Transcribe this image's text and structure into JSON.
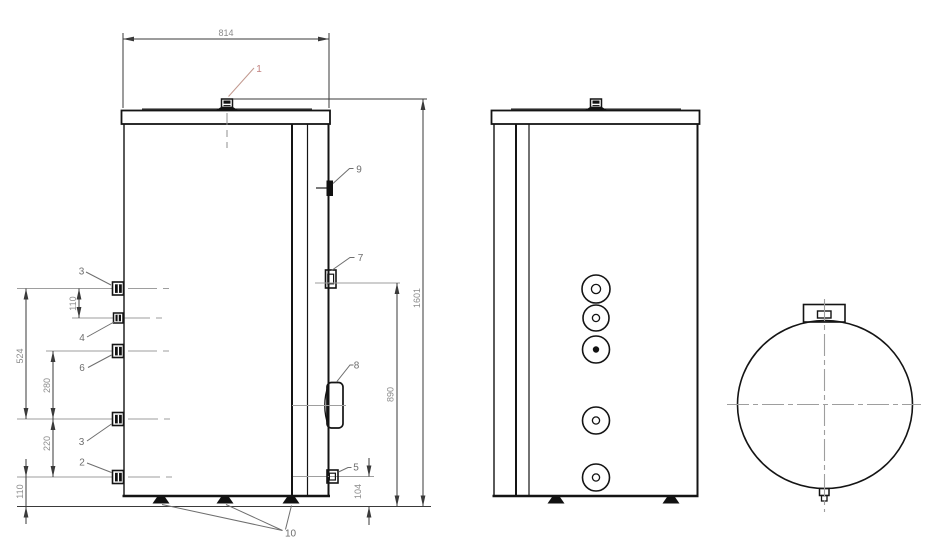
{
  "drawing": {
    "type": "tank-technical-drawing",
    "colors": {
      "line": "#141414",
      "dimension_line": "#3a3a3a",
      "dimension_text": "#8c8c8c",
      "centerline": "#9e9e9e",
      "callout_text": "#6e6e6e",
      "callout_highlight": "#c2807f"
    },
    "dimensions": {
      "top_width": "814",
      "overall_height": "1601",
      "port7_height": "890",
      "port5_height": "104",
      "port3_to_port4": "110",
      "port3_span": "524",
      "port6_to_port3": "280",
      "port3_to_port2": "220",
      "port2_height": "110"
    },
    "callouts": {
      "top_fitting": "1",
      "port2": "2",
      "port3_upper": "3",
      "port3_lower": "3",
      "port4": "4",
      "port5": "5",
      "port6": "6",
      "port7": "7",
      "port8": "8",
      "port9": "9",
      "feet": "10"
    }
  }
}
